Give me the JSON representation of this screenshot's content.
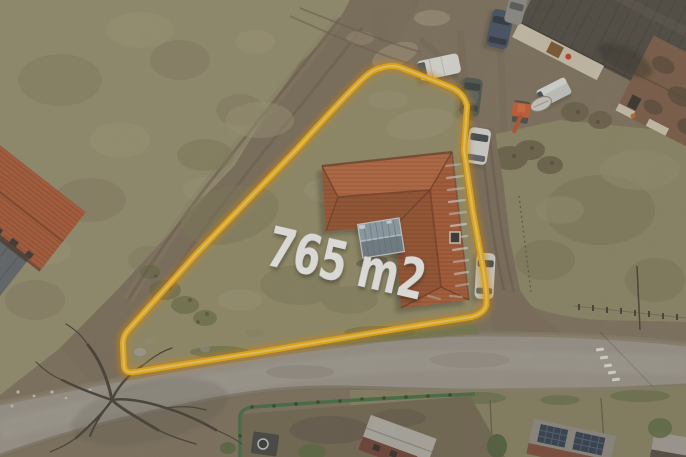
{
  "canvas": {
    "width": 686,
    "height": 457
  },
  "scene": {
    "kind": "aerial-drone-photo",
    "subject": "building plot with house, boundary outlined for sale listing",
    "annotation": {
      "area_label": "765 m2",
      "label_color": "#FFFFFF",
      "boundary_color": "#FFB300",
      "boundary_glow_color": "#E68A00",
      "boundary_highlight_color": "#FFD75E"
    },
    "palette": {
      "dirt": "#80715C",
      "field_grass": "#98926E",
      "plot_grass": "#968F67",
      "neighbor_grass": "#8E8865",
      "asphalt_road": "#9E988E",
      "roof_terracotta": "#B4592E",
      "roof_dark": "#49433C",
      "roof_rust": "#7B5A42",
      "shed_metal": "#8798A4",
      "verge_green": "#6F7A46",
      "construction_fence_green": "#3E6B3F",
      "tree": "#3E382E"
    }
  }
}
